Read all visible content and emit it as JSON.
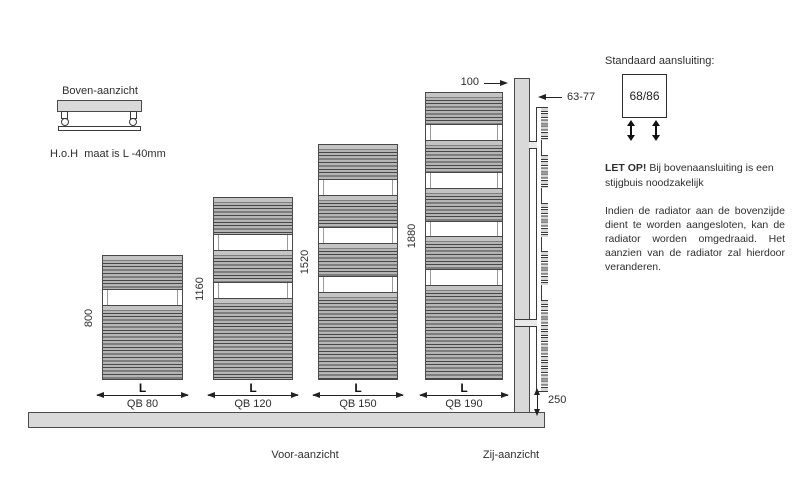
{
  "top_view": {
    "title": "Boven-aanzicht",
    "note": "H.o.H  maat is L -40mm"
  },
  "front_view": {
    "caption": "Voor-aanzicht",
    "width_label": "L",
    "radiators": [
      {
        "model": "QB 80",
        "height": "800"
      },
      {
        "model": "QB 120",
        "height": "1160"
      },
      {
        "model": "QB 150",
        "height": "1520"
      },
      {
        "model": "QB 190",
        "height": "1880"
      }
    ]
  },
  "side_view": {
    "caption": "Zij-aanzicht",
    "top_offset": "100",
    "depth": "63-77",
    "bottom_clearance": "250"
  },
  "panel": {
    "title": "Standaard aansluiting:",
    "box_label": "68/86",
    "warning_bold": "LET OP!",
    "warning_line1": " Bij bovenaansluiting is een",
    "warning_line2": "stijgbuis noodzakelijk",
    "body": "Indien de radiator aan de bovenzijde dient te worden aangesloten, kan de radiator worden omgedraaid. Het aanzien van de radiator zal hierdoor veranderen."
  },
  "colors": {
    "line": "#3a3a3a",
    "construction_gray": "#d9d9d9",
    "slat_gray": "#b5b5b5"
  }
}
